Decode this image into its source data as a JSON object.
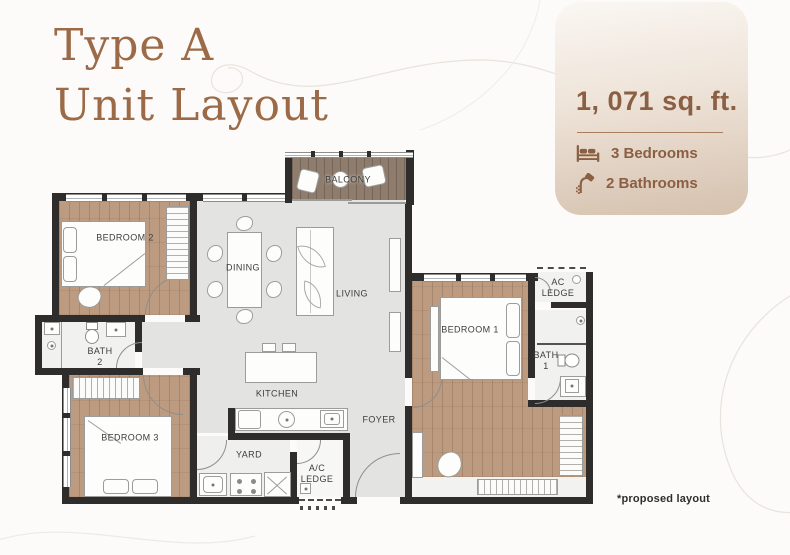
{
  "header": {
    "title_line1": "Type A",
    "title_line2": "Unit Layout"
  },
  "stats_card": {
    "area": "1, 071 sq. ft.",
    "bedrooms_label": "3 Bedrooms",
    "bathrooms_label": "2 Bathrooms",
    "accent_color": "#8a5f43",
    "gradient_top": "#faf7f3",
    "gradient_bottom": "#d5c1ae"
  },
  "floor_plan": {
    "rooms": [
      {
        "id": "balcony",
        "label": "BALCONY"
      },
      {
        "id": "bedroom-2",
        "label": "BEDROOM 2"
      },
      {
        "id": "dining",
        "label": "DINING"
      },
      {
        "id": "living",
        "label": "LIVING"
      },
      {
        "id": "kitchen",
        "label": "KITCHEN"
      },
      {
        "id": "yard",
        "label": "YARD"
      },
      {
        "id": "ac-ledge-lower",
        "label": "A/C\nLEDGE"
      },
      {
        "id": "foyer",
        "label": "FOYER"
      },
      {
        "id": "bedroom-1",
        "label": "BEDROOM 1"
      },
      {
        "id": "ac-ledge-upper",
        "label": "AC\nLEDGE"
      },
      {
        "id": "bath-1",
        "label": "BATH\n1"
      },
      {
        "id": "bath-2",
        "label": "BATH\n2"
      },
      {
        "id": "bedroom-3",
        "label": "BEDROOM 3"
      }
    ],
    "colors": {
      "wall": "#2f2d2b",
      "wood_floor": "#bd9b80",
      "balcony_floor": "#8e7c6d",
      "tile_floor": "#e3e4e2",
      "bath_floor": "#f1f1ef"
    }
  },
  "footer": {
    "note": "*proposed layout"
  },
  "colors": {
    "title": "#9c6a47",
    "background": "#fcfbf9"
  }
}
